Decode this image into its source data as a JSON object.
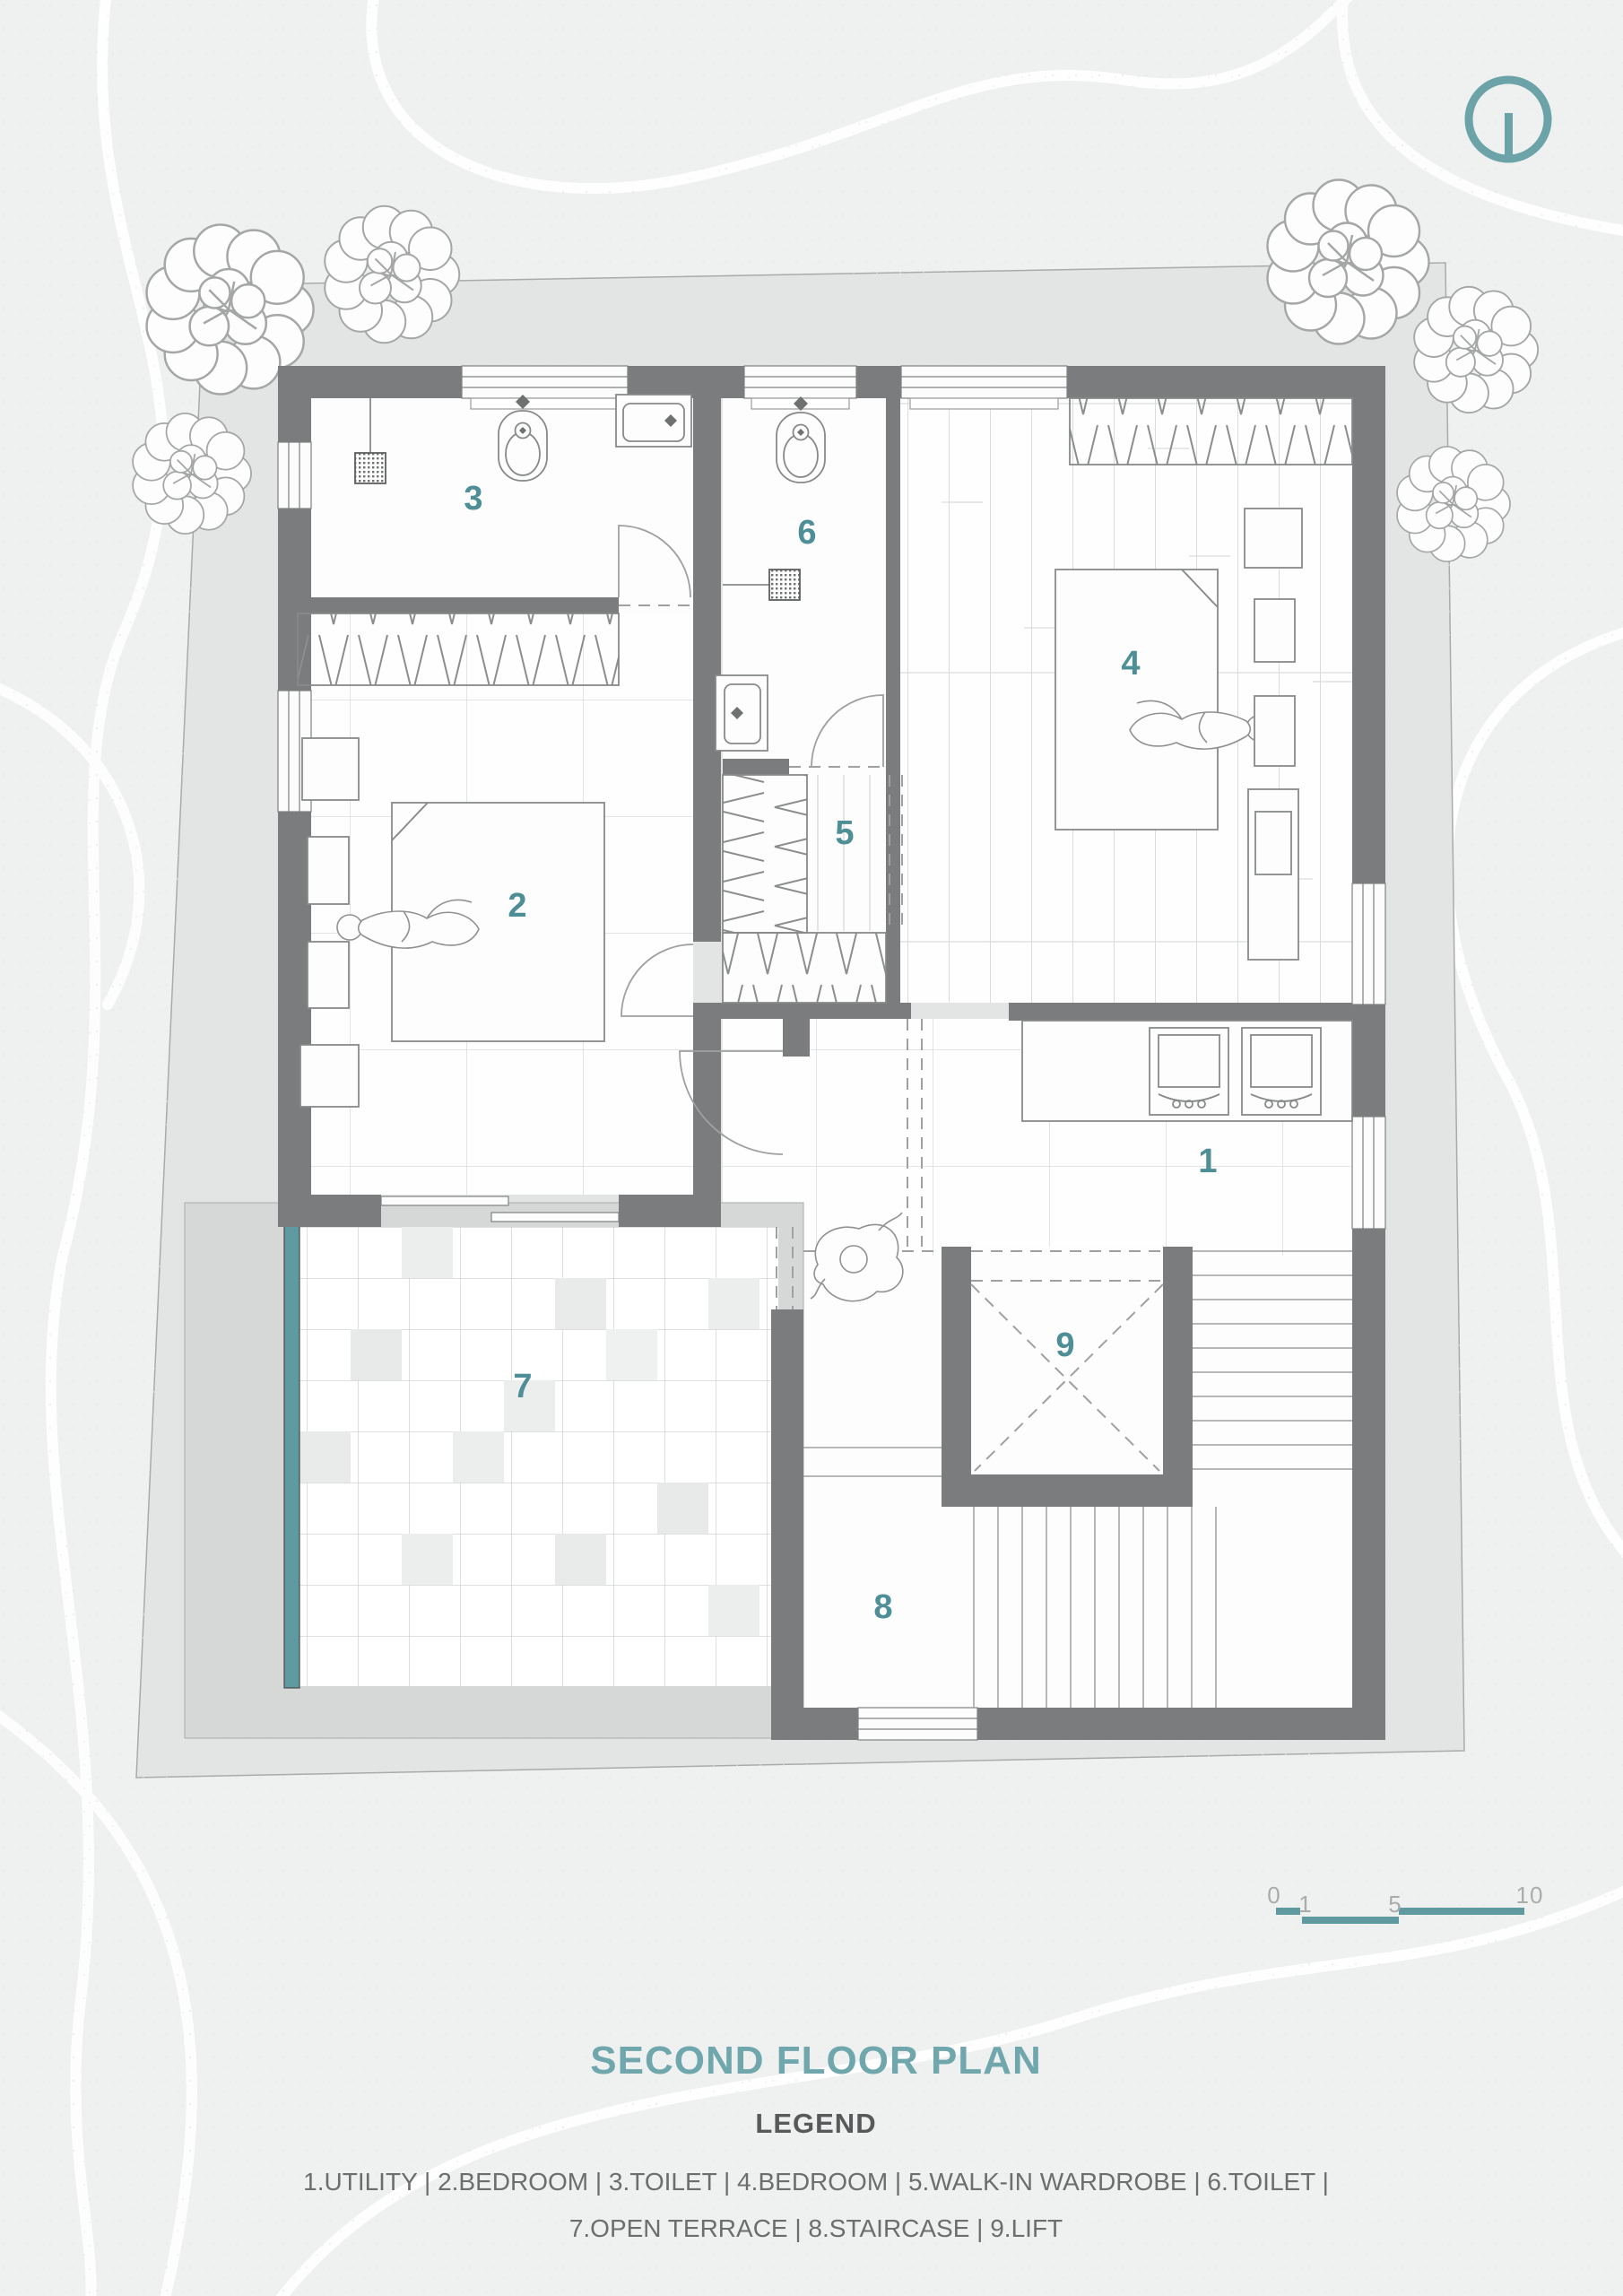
{
  "document": {
    "title": "SECOND FLOOR PLAN",
    "legend_heading": "LEGEND",
    "legend_lines": [
      "1.UTILITY  | 2.BEDROOM | 3.TOILET | 4.BEDROOM  | 5.WALK-IN WARDROBE | 6.TOILET |",
      "7.OPEN TERRACE | 8.STAIRCASE | 9.LIFT"
    ]
  },
  "rooms": [
    {
      "number": "1",
      "name": "UTILITY"
    },
    {
      "number": "2",
      "name": "BEDROOM"
    },
    {
      "number": "3",
      "name": "TOILET"
    },
    {
      "number": "4",
      "name": "BEDROOM"
    },
    {
      "number": "5",
      "name": "WALK-IN WARDROBE"
    },
    {
      "number": "6",
      "name": "TOILET"
    },
    {
      "number": "7",
      "name": "OPEN TERRACE"
    },
    {
      "number": "8",
      "name": "STAIRCASE"
    },
    {
      "number": "9",
      "name": "LIFT"
    }
  ],
  "scale_bar": {
    "labels": [
      "0",
      "1",
      "5",
      "10"
    ]
  },
  "icons": {
    "north_indicator": "circle-with-vertical-bar"
  },
  "colors": {
    "accent_title": "#6FA7AD",
    "room_number": "#4E8E97",
    "wall": "#7A7C7D",
    "scale_bar_teal": "#5F9AA0",
    "planter_teal": "#5F9AA0",
    "site_fill": "#E3E5E5",
    "background": "#EFF1F0",
    "legend_text": "#6B6E6D"
  }
}
